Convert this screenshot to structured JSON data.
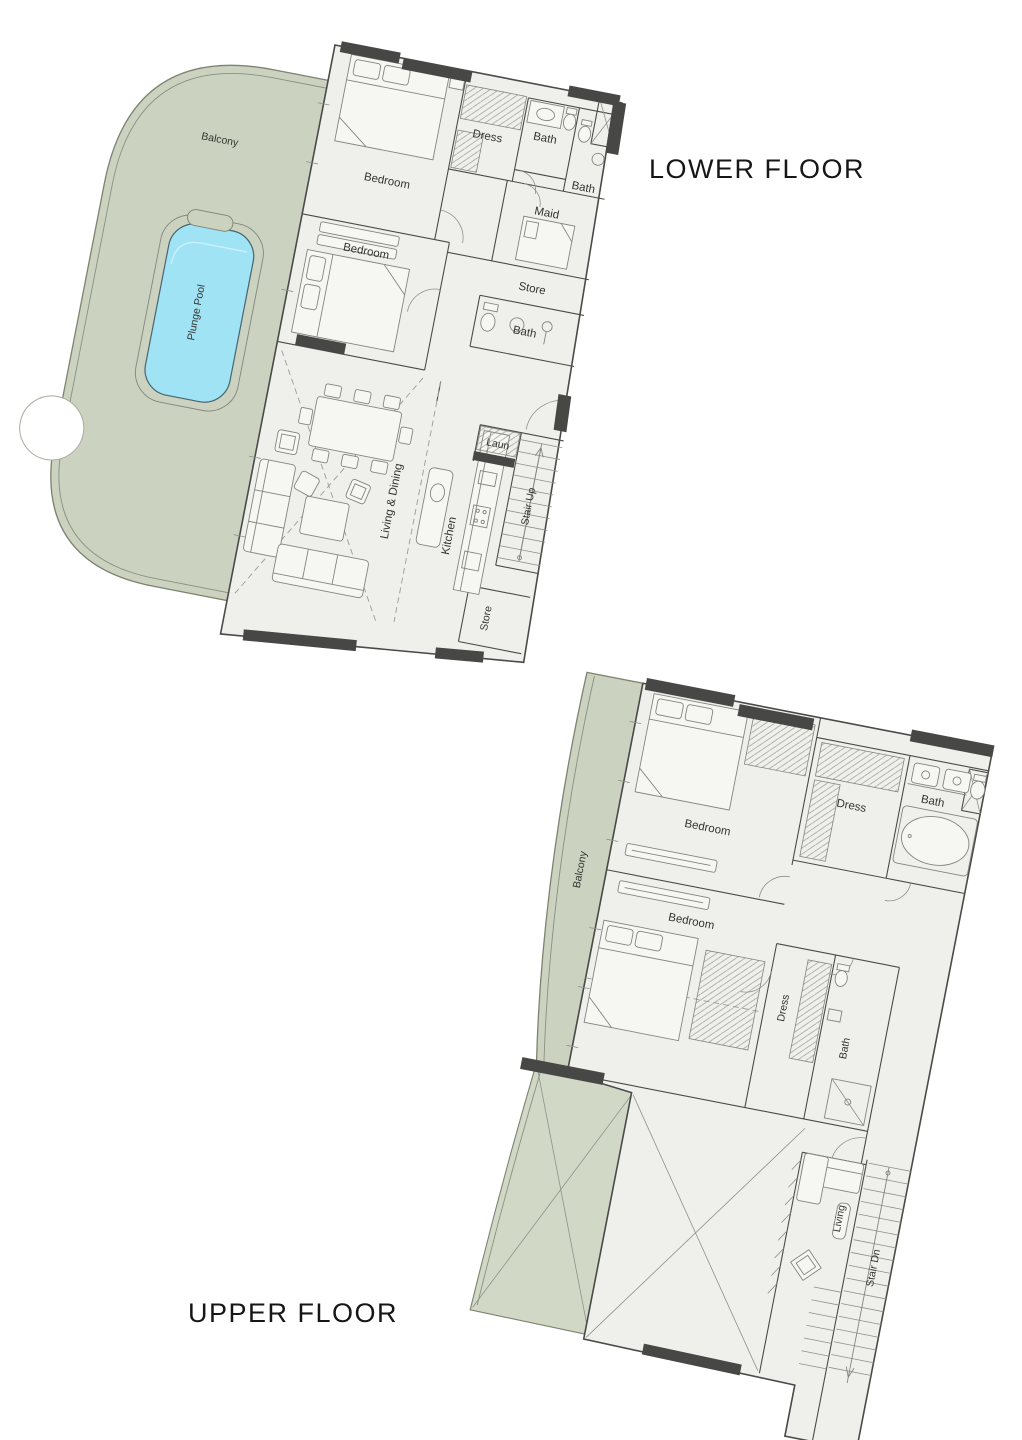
{
  "titles": {
    "lower": "LOWER FLOOR",
    "upper": "UPPER FLOOR"
  },
  "lower": {
    "rooms": {
      "balcony": "Balcony",
      "plunge_pool": "Plunge Pool",
      "bedroom1": "Bedroom",
      "bedroom2": "Bedroom",
      "dress": "Dress",
      "bath1": "Bath",
      "bath2": "Bath",
      "maid": "Maid",
      "store1": "Store",
      "bath3": "Bath",
      "living_dining": "Living & Dining",
      "kitchen": "Kitchen",
      "laundry": "Laun",
      "stair": "Stair Up",
      "store2": "Store"
    }
  },
  "upper": {
    "rooms": {
      "balcony": "Balcony",
      "bedroom1": "Bedroom",
      "dress1": "Dress",
      "bath1": "Bath",
      "bedroom2": "Bedroom",
      "dress2": "Dress",
      "bath2": "Bath",
      "living": "Living",
      "stair": "Stair Dn"
    }
  },
  "colors": {
    "balcony_green": "#cbd2bf",
    "terrace_green": "#d1d8c6",
    "balcony_stroke": "#7d8370",
    "pool_blue": "#9fe3f5",
    "pool_inner": "#cdf0fa",
    "pool_stroke": "#49656f",
    "floor_gray": "#efefec",
    "wall_line": "#4a4a48",
    "wall_dark": "#474745",
    "furniture_line": "#85857f",
    "label_color": "#333331",
    "title_color": "#161616"
  }
}
